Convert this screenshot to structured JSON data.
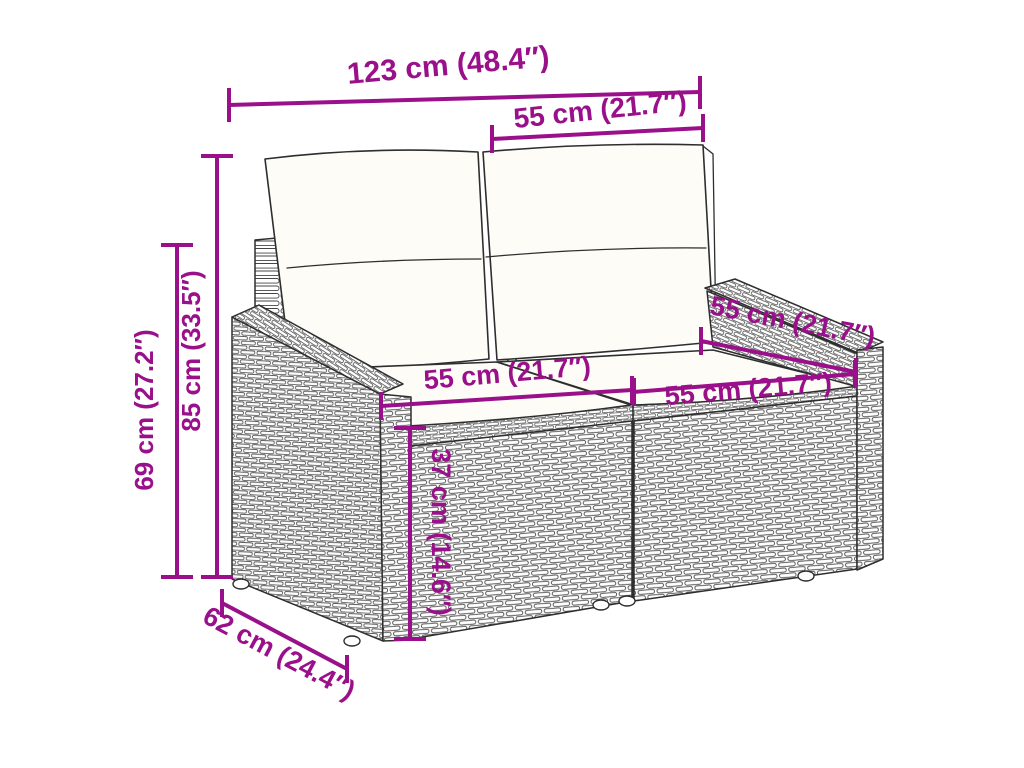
{
  "accent_color": "#9a108a",
  "figure": {
    "description": "Dimension diagram line drawing of a poly rattan 2-seater garden sofa with back and seat cushions",
    "dimensions": {
      "total_width": "123 cm (48.4″)",
      "back_seat_width": "55 cm (21.7″)",
      "total_height": "85 cm (33.5″)",
      "back_height": "69 cm (27.2″)",
      "left_seat_width": "55 cm (21.7″)",
      "right_seat_width": "55 cm (21.7″)",
      "seat_depth": "55 cm (21.7″)",
      "seat_height": "37 cm (14.6″)",
      "overall_depth": "62 cm (24.4″)"
    }
  }
}
